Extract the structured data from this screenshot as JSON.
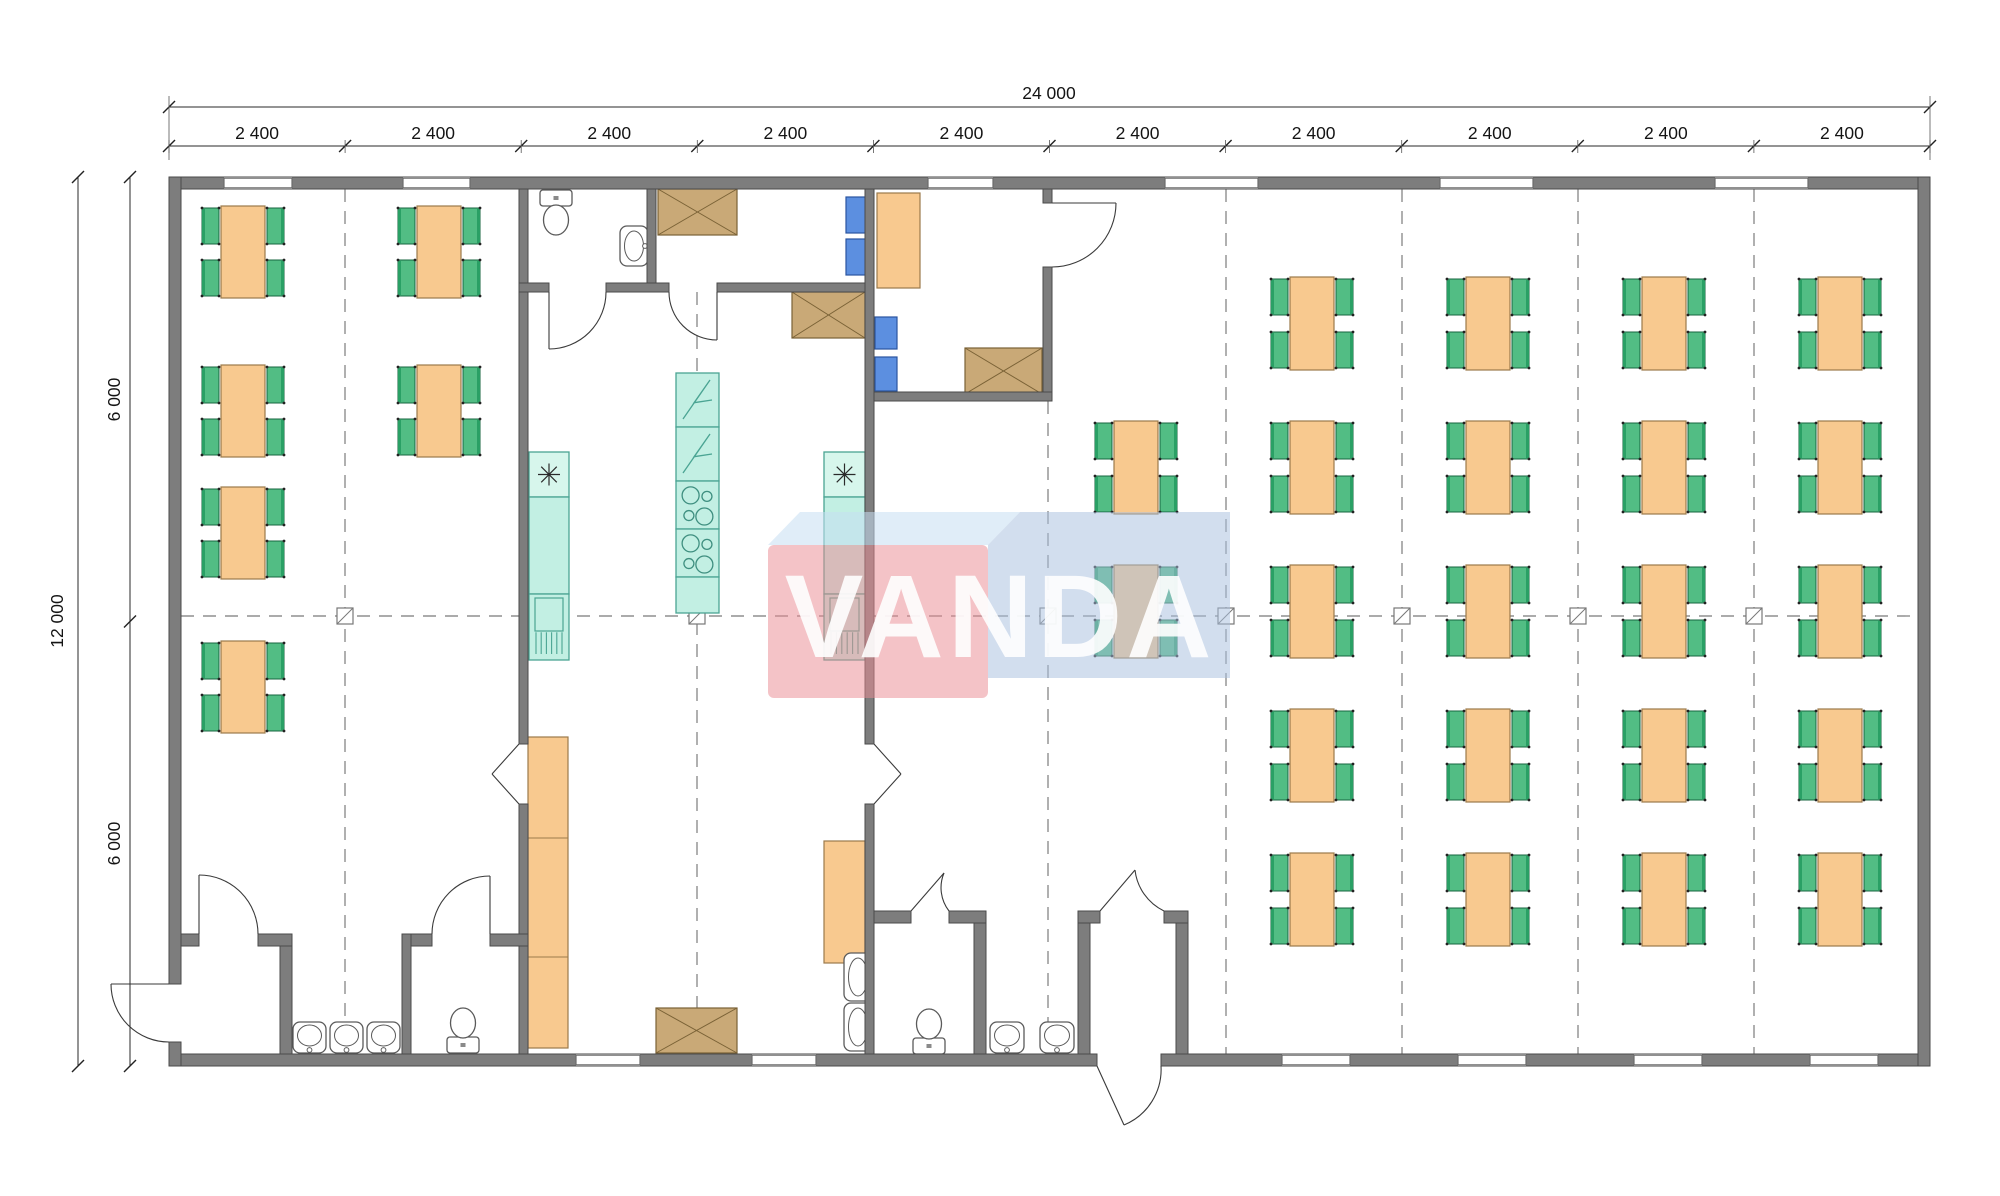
{
  "drawing": {
    "type": "architectural-floor-plan",
    "subject": "modular canteen building plan 24000 x 12000 mm"
  },
  "labels": {
    "total_width": "24 000",
    "bay": "2 400",
    "bay_count": 10,
    "total_height": "12 000",
    "half_height": "6 000"
  },
  "watermark": {
    "text": "VANDA",
    "pink": "rgba(234,140,148,0.52)",
    "band": "rgba(198,222,242,0.55)",
    "blue": "rgba(168,192,222,0.52)",
    "text_color": "#ffffff"
  },
  "colors": {
    "wall_fill": "#7d7d7d",
    "wall_stroke": "#4a4a4a",
    "table_fill": "#f8c98f",
    "table_stroke": "#9b7a4b",
    "chair_fill": "#52bd84",
    "chair_back": "#2aa065",
    "chair_stroke": "#17663f",
    "teal_fill": "#c2efe3",
    "teal_light": "#d7f6ec",
    "teal_stroke": "#4aa493",
    "blue_fill": "#5c8fe0",
    "blue_stroke": "#2b55a0",
    "brown_fill": "#c9a977",
    "brown_stroke": "#7a6236",
    "fixture_stroke": "#5a5a5a",
    "dash_color": "#8f8f8f",
    "dim_color": "#2a2a2a",
    "door_color": "#3a3a3a"
  },
  "geometry": {
    "walls": [
      [
        169,
        177,
        1761,
        12
      ],
      [
        169,
        1054,
        928,
        12
      ],
      [
        1161,
        1054,
        769,
        12
      ],
      [
        169,
        177,
        12,
        807
      ],
      [
        169,
        1042,
        12,
        24
      ],
      [
        1918,
        177,
        12,
        889
      ],
      [
        519,
        189,
        9,
        555
      ],
      [
        519,
        804,
        9,
        250
      ],
      [
        519,
        283,
        30,
        9
      ],
      [
        606,
        283,
        63,
        9
      ],
      [
        717,
        283,
        156,
        9
      ],
      [
        647,
        189,
        9,
        94
      ],
      [
        865,
        189,
        9,
        555
      ],
      [
        865,
        804,
        9,
        250
      ],
      [
        874,
        392,
        178,
        9
      ],
      [
        1043,
        189,
        9,
        14
      ],
      [
        1043,
        267,
        9,
        125
      ],
      [
        181,
        934,
        18,
        12
      ],
      [
        258,
        934,
        34,
        12
      ],
      [
        280,
        946,
        12,
        108
      ],
      [
        402,
        934,
        9,
        120
      ],
      [
        411,
        934,
        21,
        12
      ],
      [
        490,
        934,
        38,
        12
      ],
      [
        874,
        911,
        37,
        12
      ],
      [
        949,
        911,
        37,
        12
      ],
      [
        974,
        923,
        12,
        131
      ],
      [
        1078,
        911,
        22,
        12
      ],
      [
        1164,
        911,
        24,
        12
      ],
      [
        1078,
        923,
        12,
        131
      ],
      [
        1176,
        923,
        12,
        131
      ]
    ],
    "windows_top": [
      [
        224,
        292
      ],
      [
        403,
        470
      ],
      [
        928,
        993
      ],
      [
        1165,
        1258
      ],
      [
        1440,
        1533
      ],
      [
        1715,
        1808
      ]
    ],
    "windows_bottom": [
      [
        576,
        640
      ],
      [
        752,
        816
      ],
      [
        1282,
        1350
      ],
      [
        1458,
        1526
      ],
      [
        1634,
        1702
      ],
      [
        1810,
        1878
      ]
    ],
    "wall_y_top": 177,
    "wall_y_bottom": 1054,
    "dash_vertical": [
      [
        345,
        189,
        1054
      ],
      [
        697,
        292,
        1054
      ],
      [
        1048,
        401,
        1054
      ],
      [
        1226,
        189,
        1054
      ],
      [
        1402,
        189,
        1054
      ],
      [
        1578,
        189,
        1054
      ],
      [
        1754,
        189,
        1054
      ]
    ],
    "dash_horizontal": [
      [
        616,
        181,
        1918
      ]
    ],
    "connectors": [
      [
        345,
        616
      ],
      [
        697,
        616
      ],
      [
        1048,
        616
      ],
      [
        1226,
        616
      ],
      [
        1402,
        616
      ],
      [
        1578,
        616
      ],
      [
        1754,
        616
      ]
    ],
    "doors": [
      {
        "arc": "M 606 292 A 57 57 0 0 1 549 349",
        "leaf": "M 549 292 L 549 349"
      },
      {
        "arc": "M 669 292 A 48 48 0 0 0 717 340",
        "leaf": "M 717 292 L 717 340"
      },
      {
        "arc": "M 432 934 A 58 58 0 0 1 490 876",
        "leaf": "M 490 934 L 490 876"
      },
      {
        "arc": "M 258 934 A 59 59 0 0 0 199 875",
        "leaf": "M 199 934 L 199 875"
      },
      {
        "arc": "M 169 1042 A 58 58 0 0 1 111 984",
        "leaf": "M 169 984 L 111 984"
      },
      {
        "arc": "M 1052 267 A 64 64 0 0 0 1116 203",
        "leaf": "M 1052 203 L 1116 203"
      },
      {
        "arc": "M 949 911 A 38 38 0 0 1 944 873",
        "leaf": "M 911 911 L 944 873"
      },
      {
        "arc": "M 1164 911 A 52 52 0 0 1 1135 870",
        "leaf": "M 1100 911 L 1135 870"
      },
      {
        "arc": "M 1161 1066 A 60 60 0 0 1 1124 1125",
        "leaf": "M 1097 1066 L 1124 1125"
      },
      {
        "arc": "M 519 744 L 492 774 M 519 804 L 492 774",
        "leaf": ""
      },
      {
        "arc": "M 874 744 L 901 774 M 874 804 L 901 774",
        "leaf": ""
      }
    ],
    "tables": [
      [
        221,
        206,
        44,
        92
      ],
      [
        221,
        365,
        44,
        92
      ],
      [
        221,
        487,
        44,
        92
      ],
      [
        221,
        641,
        44,
        92
      ],
      [
        417,
        206,
        44,
        92
      ],
      [
        417,
        365,
        44,
        92
      ],
      [
        1114,
        421,
        44,
        93
      ],
      [
        1114,
        565,
        44,
        93
      ],
      [
        1290,
        277,
        44,
        93
      ],
      [
        1290,
        421,
        44,
        93
      ],
      [
        1290,
        565,
        44,
        93
      ],
      [
        1290,
        709,
        44,
        93
      ],
      [
        1290,
        853,
        44,
        93
      ],
      [
        1466,
        277,
        44,
        93
      ],
      [
        1466,
        421,
        44,
        93
      ],
      [
        1466,
        565,
        44,
        93
      ],
      [
        1466,
        709,
        44,
        93
      ],
      [
        1466,
        853,
        44,
        93
      ],
      [
        1642,
        277,
        44,
        93
      ],
      [
        1642,
        421,
        44,
        93
      ],
      [
        1642,
        565,
        44,
        93
      ],
      [
        1642,
        709,
        44,
        93
      ],
      [
        1642,
        853,
        44,
        93
      ],
      [
        1818,
        277,
        44,
        93
      ],
      [
        1818,
        421,
        44,
        93
      ],
      [
        1818,
        565,
        44,
        93
      ],
      [
        1818,
        709,
        44,
        93
      ],
      [
        1818,
        853,
        44,
        93
      ]
    ],
    "desks": [
      [
        877,
        193,
        43,
        95
      ]
    ],
    "appliance_columns": [
      {
        "x": 529,
        "w": 40,
        "sections": [
          {
            "y": 452,
            "h": 45,
            "kind": "star"
          },
          {
            "y": 497,
            "h": 97,
            "kind": "plain"
          },
          {
            "y": 594,
            "h": 66,
            "kind": "grill"
          }
        ]
      },
      {
        "x": 676,
        "w": 43,
        "sections": [
          {
            "y": 373,
            "h": 54,
            "kind": "zig"
          },
          {
            "y": 427,
            "h": 54,
            "kind": "zig"
          },
          {
            "y": 481,
            "h": 48,
            "kind": "burner"
          },
          {
            "y": 529,
            "h": 48,
            "kind": "burner"
          },
          {
            "y": 577,
            "h": 36,
            "kind": "plain"
          }
        ]
      },
      {
        "x": 824,
        "w": 41,
        "sections": [
          {
            "y": 452,
            "h": 45,
            "kind": "star"
          },
          {
            "y": 497,
            "h": 97,
            "kind": "plain"
          },
          {
            "y": 594,
            "h": 66,
            "kind": "grill"
          }
        ]
      }
    ],
    "cabinets": [
      {
        "r": [
          528,
          737,
          40,
          311
        ],
        "div": [
          838,
          957
        ]
      },
      {
        "r": [
          824,
          841,
          41,
          122
        ],
        "div": []
      }
    ],
    "xboxes": [
      [
        658,
        189,
        79,
        46
      ],
      [
        792,
        292,
        73,
        46
      ],
      [
        965,
        348,
        77,
        46
      ],
      [
        656,
        1008,
        81,
        45
      ]
    ],
    "blues": [
      [
        846,
        197,
        20,
        36
      ],
      [
        846,
        239,
        20,
        36
      ],
      [
        875,
        317,
        22,
        32
      ],
      [
        875,
        357,
        22,
        34
      ]
    ],
    "fixtures": [
      {
        "t": "wc",
        "dir": "down",
        "x": 556,
        "y": 190
      },
      {
        "t": "wc",
        "dir": "up",
        "x": 463,
        "y": 1053
      },
      {
        "t": "wc",
        "dir": "up",
        "x": 929,
        "y": 1054
      },
      {
        "t": "basin",
        "dir": "left",
        "x": 620,
        "y": 226,
        "w": 28,
        "h": 40
      },
      {
        "t": "basin",
        "dir": "down",
        "x": 293,
        "y": 1022,
        "w": 33,
        "h": 31
      },
      {
        "t": "basin",
        "dir": "down",
        "x": 330,
        "y": 1022,
        "w": 33,
        "h": 31
      },
      {
        "t": "basin",
        "dir": "down",
        "x": 367,
        "y": 1022,
        "w": 33,
        "h": 31
      },
      {
        "t": "basin",
        "dir": "down",
        "x": 990,
        "y": 1022,
        "w": 34,
        "h": 31
      },
      {
        "t": "basin",
        "dir": "down",
        "x": 1040,
        "y": 1022,
        "w": 34,
        "h": 31
      },
      {
        "t": "basin",
        "dir": "right",
        "x": 844,
        "y": 953,
        "w": 28,
        "h": 48
      },
      {
        "t": "basin",
        "dir": "right",
        "x": 844,
        "y": 1003,
        "w": 28,
        "h": 48
      }
    ],
    "dims": {
      "line1_y": 107,
      "line2_y": 146,
      "modules_x": [
        169,
        345.1,
        521.2,
        697.3,
        873.4,
        1049.5,
        1225.6,
        1401.7,
        1577.8,
        1753.9,
        1930
      ],
      "vline1_x": 78,
      "vline2_x": 130,
      "levels_y": [
        177,
        621.5,
        1066
      ]
    }
  }
}
